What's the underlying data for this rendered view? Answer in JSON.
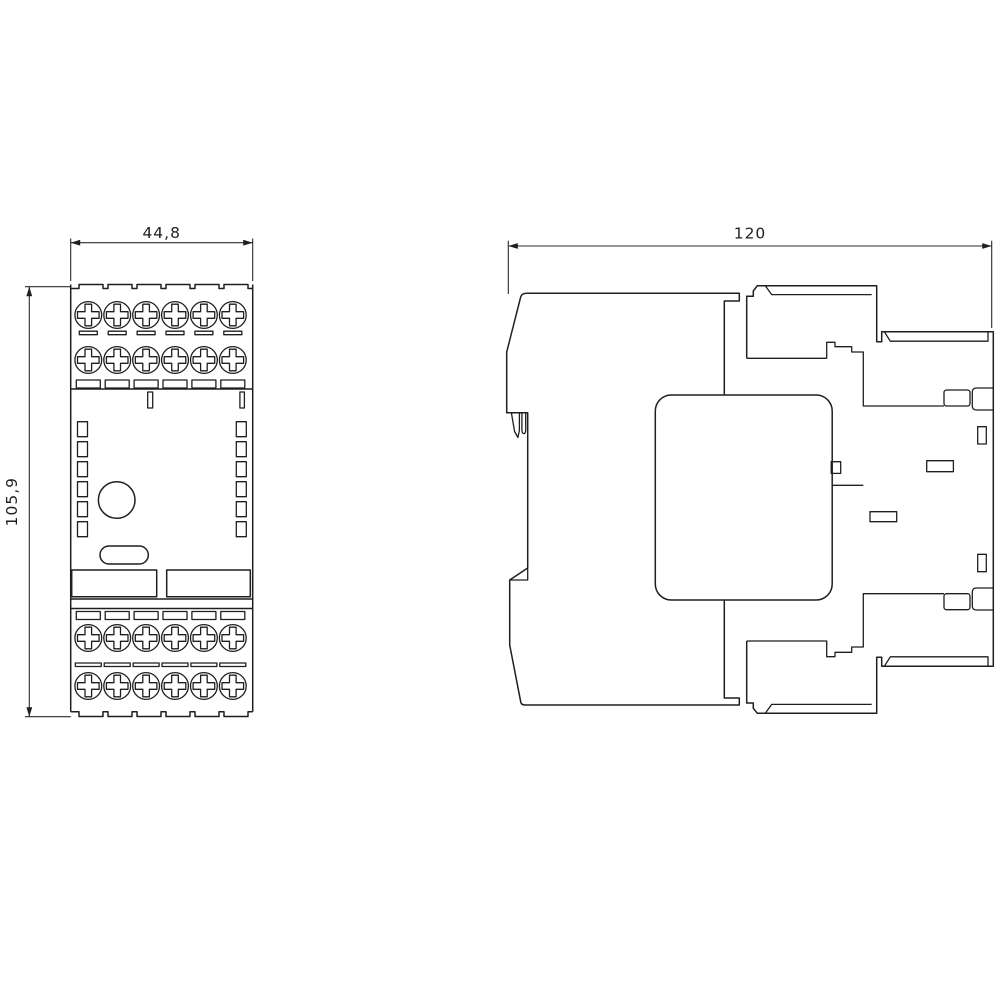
{
  "drawing": {
    "type": "dimension-drawing",
    "background": "#ffffff",
    "line_color": "#1f1f1f",
    "front_view": {
      "name": "front-view",
      "width_label": "44,8",
      "height_label": "105,9"
    },
    "side_view": {
      "name": "side-view",
      "depth_label": "120"
    }
  }
}
